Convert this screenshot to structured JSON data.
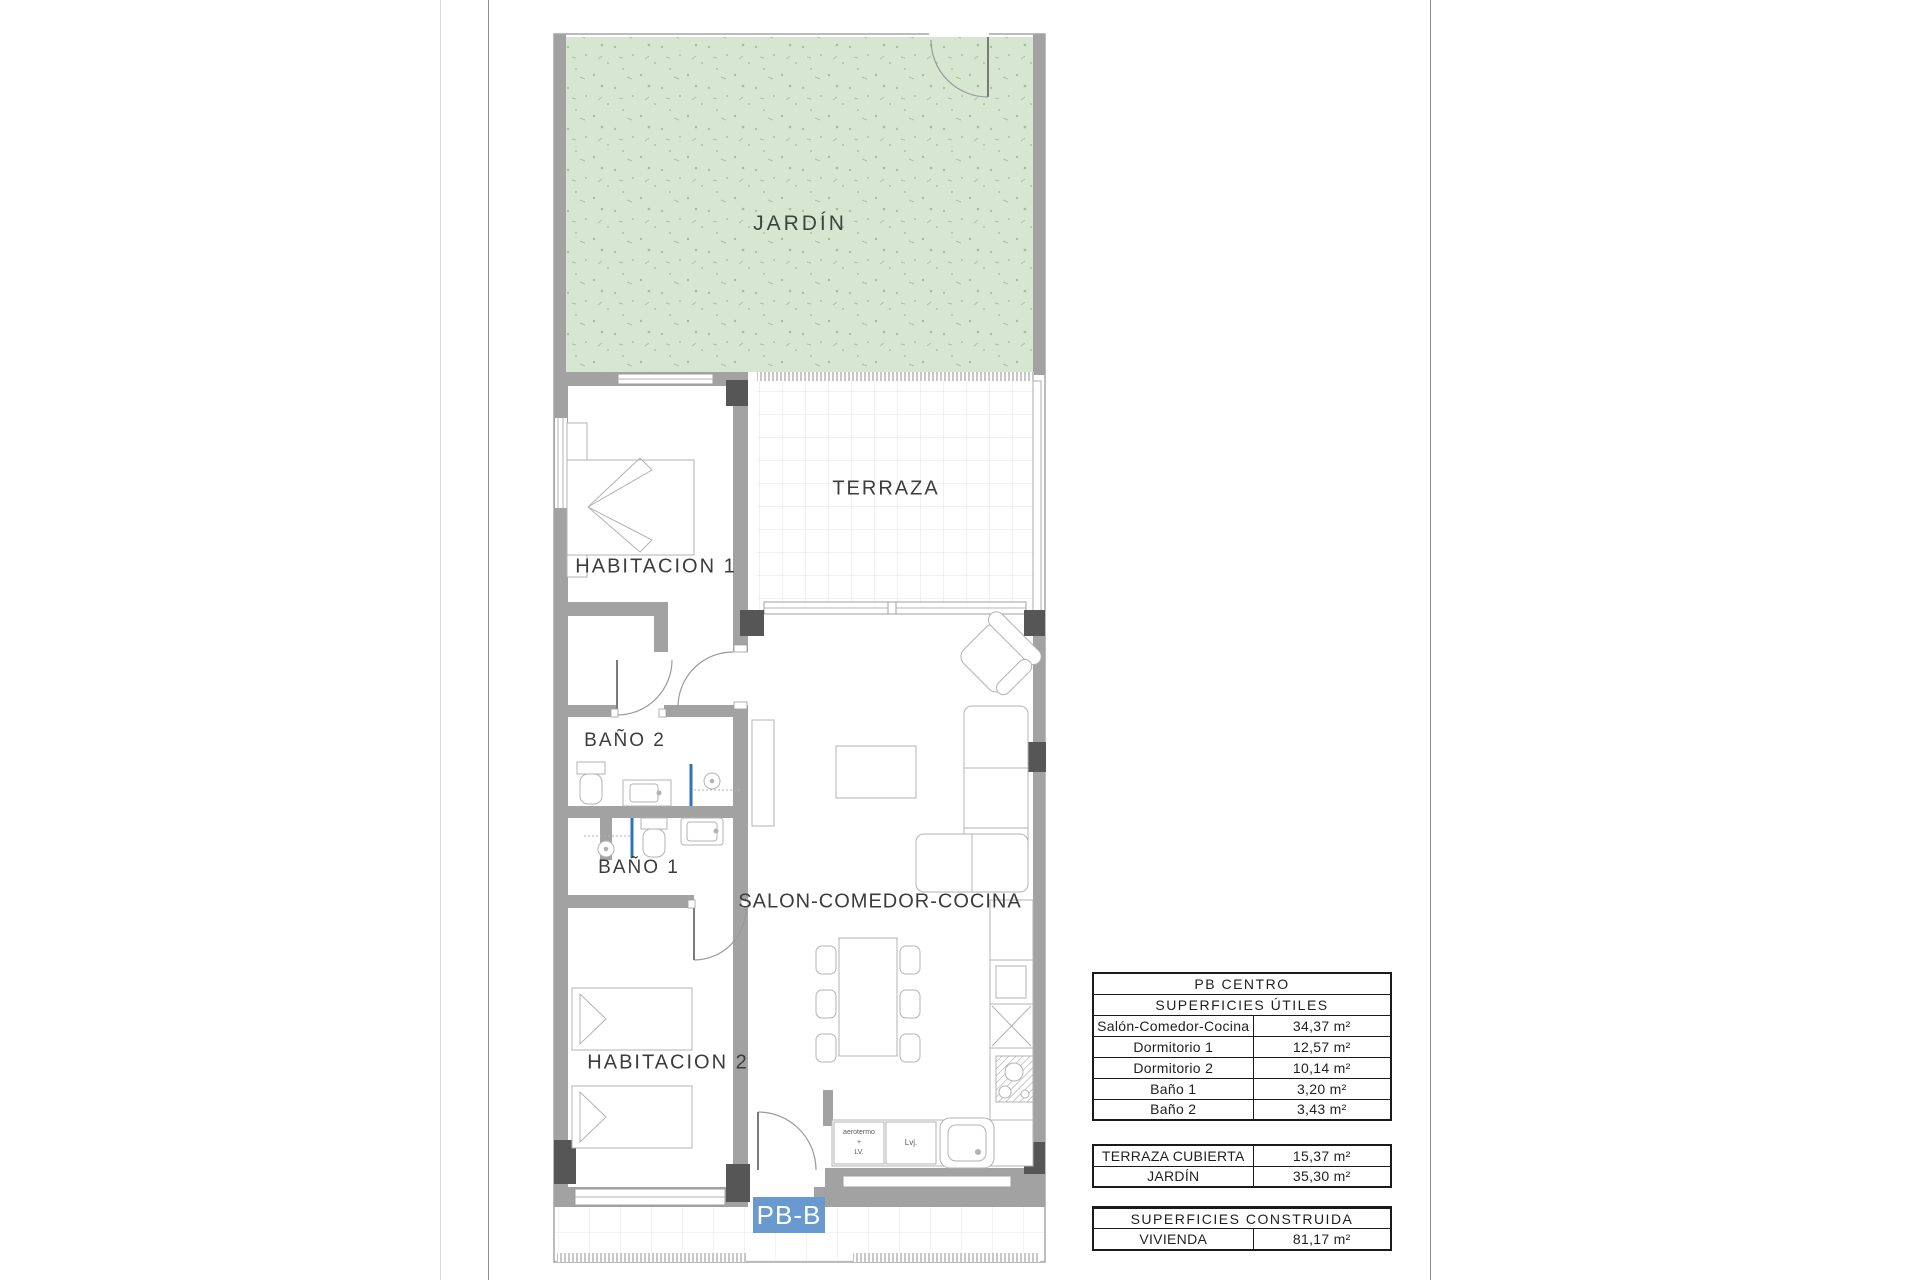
{
  "plan": {
    "unit_badge": "PB-B",
    "rooms": {
      "jardin": "JARDÍN",
      "terraza": "TERRAZA",
      "habitacion1": "HABITACION 1",
      "bano2": "BAÑO 2",
      "bano1": "BAÑO 1",
      "salon": "SALON-COMEDOR-COCINA",
      "habitacion2": "HABITACION 2"
    },
    "annotations": {
      "aerotermo_l1": "aerotermo",
      "aerotermo_l2": "+",
      "aerotermo_l3": "LV.",
      "lvj": "Lvj."
    },
    "colors": {
      "wall_gray": "#a2a2a2",
      "column_dark": "#565656",
      "garden_green": "#d6e6d0",
      "garden_speckle": "#a6c69e",
      "unit_badge_blue": "#6899cf",
      "shower_screen_blue": "#2e74b8",
      "table_border": "#1a1a1a",
      "label_ink": "#3c3c3c"
    }
  },
  "tables": {
    "utiles": {
      "title": "PB CENTRO",
      "subtitle": "SUPERFICIES ÚTILES",
      "rows": [
        {
          "label": "Salón-Comedor-Cocina",
          "value": "34,37 m²"
        },
        {
          "label": "Dormitorio 1",
          "value": "12,57 m²"
        },
        {
          "label": "Dormitorio 2",
          "value": "10,14 m²"
        },
        {
          "label": "Baño 1",
          "value": "3,20 m²"
        },
        {
          "label": "Baño 2",
          "value": "3,43 m²"
        }
      ]
    },
    "exterior": {
      "rows": [
        {
          "label": "TERRAZA CUBIERTA",
          "value": "15,37 m²"
        },
        {
          "label": "JARDÍN",
          "value": "35,30 m²"
        }
      ]
    },
    "construida": {
      "title": "SUPERFICIES CONSTRUIDA",
      "rows": [
        {
          "label": "VIVIENDA",
          "value": "81,17 m²"
        }
      ]
    }
  }
}
